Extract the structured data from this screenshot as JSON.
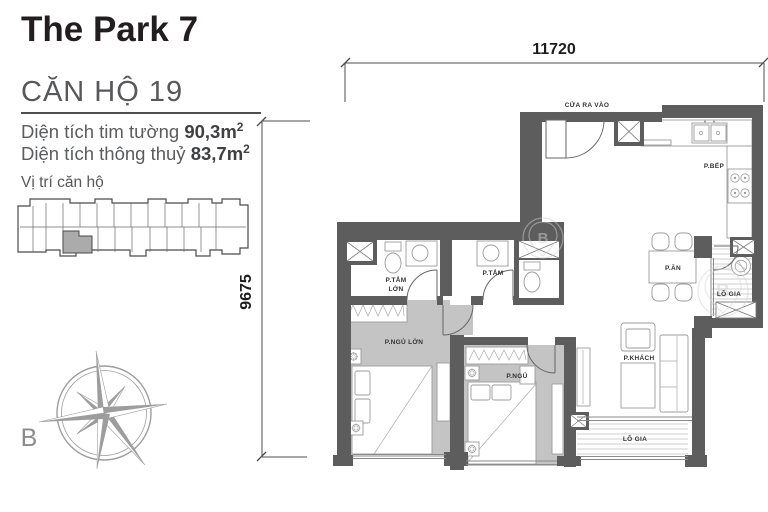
{
  "header": {
    "project_title": "The Park 7",
    "unit_title": "CĂN HỘ 19"
  },
  "areas": {
    "wall_label": "Diện tích tim tường",
    "wall_value": "90,3",
    "net_label": "Diện tích thông thuỷ",
    "net_value": "83,7",
    "unit": "m",
    "sup": "2"
  },
  "location": {
    "label": "Vị trí căn hộ"
  },
  "compass": {
    "north": "B"
  },
  "dimensions": {
    "width": "11720",
    "height": "9675"
  },
  "rooms": {
    "entrance": "CỬA RA VÀO",
    "kitchen": "P.BẾP",
    "dining": "P.ĂN",
    "loggia_right": "LÔ GIA",
    "bath_master_1": "P.TẮM",
    "bath_master_2": "LỚN",
    "bath": "P.TẮM",
    "bed_master": "P.NGỦ LỚN",
    "bed": "P.NGỦ",
    "living": "P.KHÁCH",
    "loggia_bottom": "LÔ GIA"
  },
  "watermark": {
    "letter": "B"
  }
}
